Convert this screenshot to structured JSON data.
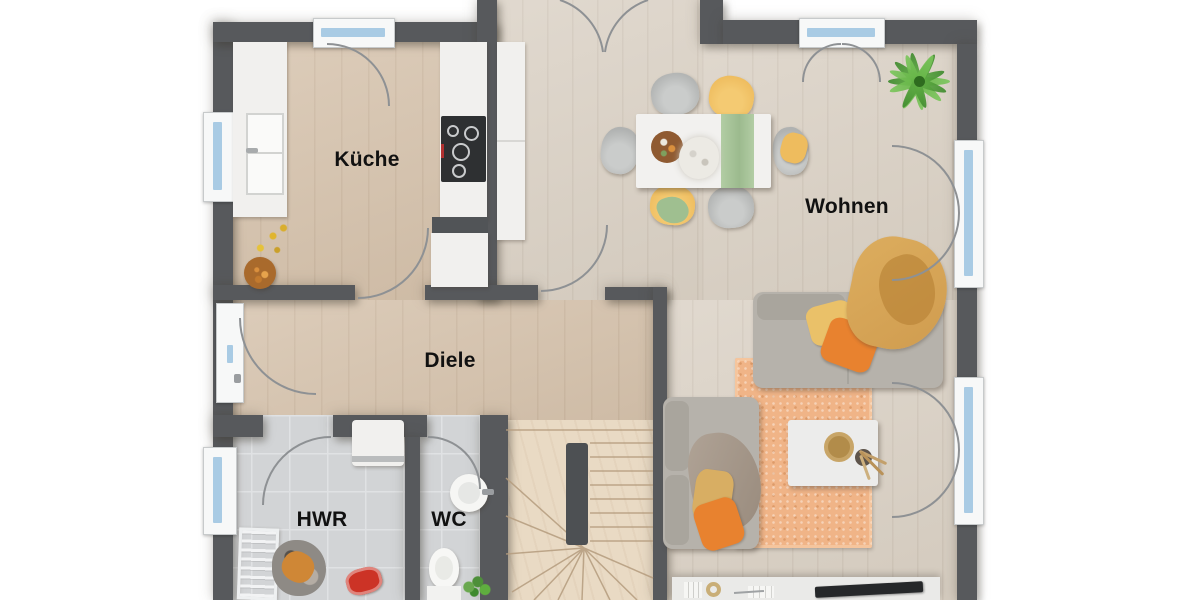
{
  "rooms": [
    {
      "id": "kueche",
      "label": "Küche"
    },
    {
      "id": "wohnen",
      "label": "Wohnen"
    },
    {
      "id": "diele",
      "label": "Diele"
    },
    {
      "id": "hwr",
      "label": "HWR"
    },
    {
      "id": "wc",
      "label": "WC"
    }
  ],
  "colors": {
    "wall": "#57595c",
    "floor_warm": "#d6c3ad",
    "floor_light": "#dbd2c6",
    "floor_tile": "#d2d4d6",
    "stair_wood": "#e9dac4",
    "glass": "#a9cbe4",
    "frame": "#f7f8f8",
    "arc": "#8e9194",
    "rug": "#f0b487",
    "sofa": "#b6b2ab",
    "runner": "#b2cda4",
    "chair_yellow": "#eebc5e",
    "pillow_orange": "#e8822f",
    "blanket_tan": "#d09c4f",
    "label": "#111111"
  }
}
